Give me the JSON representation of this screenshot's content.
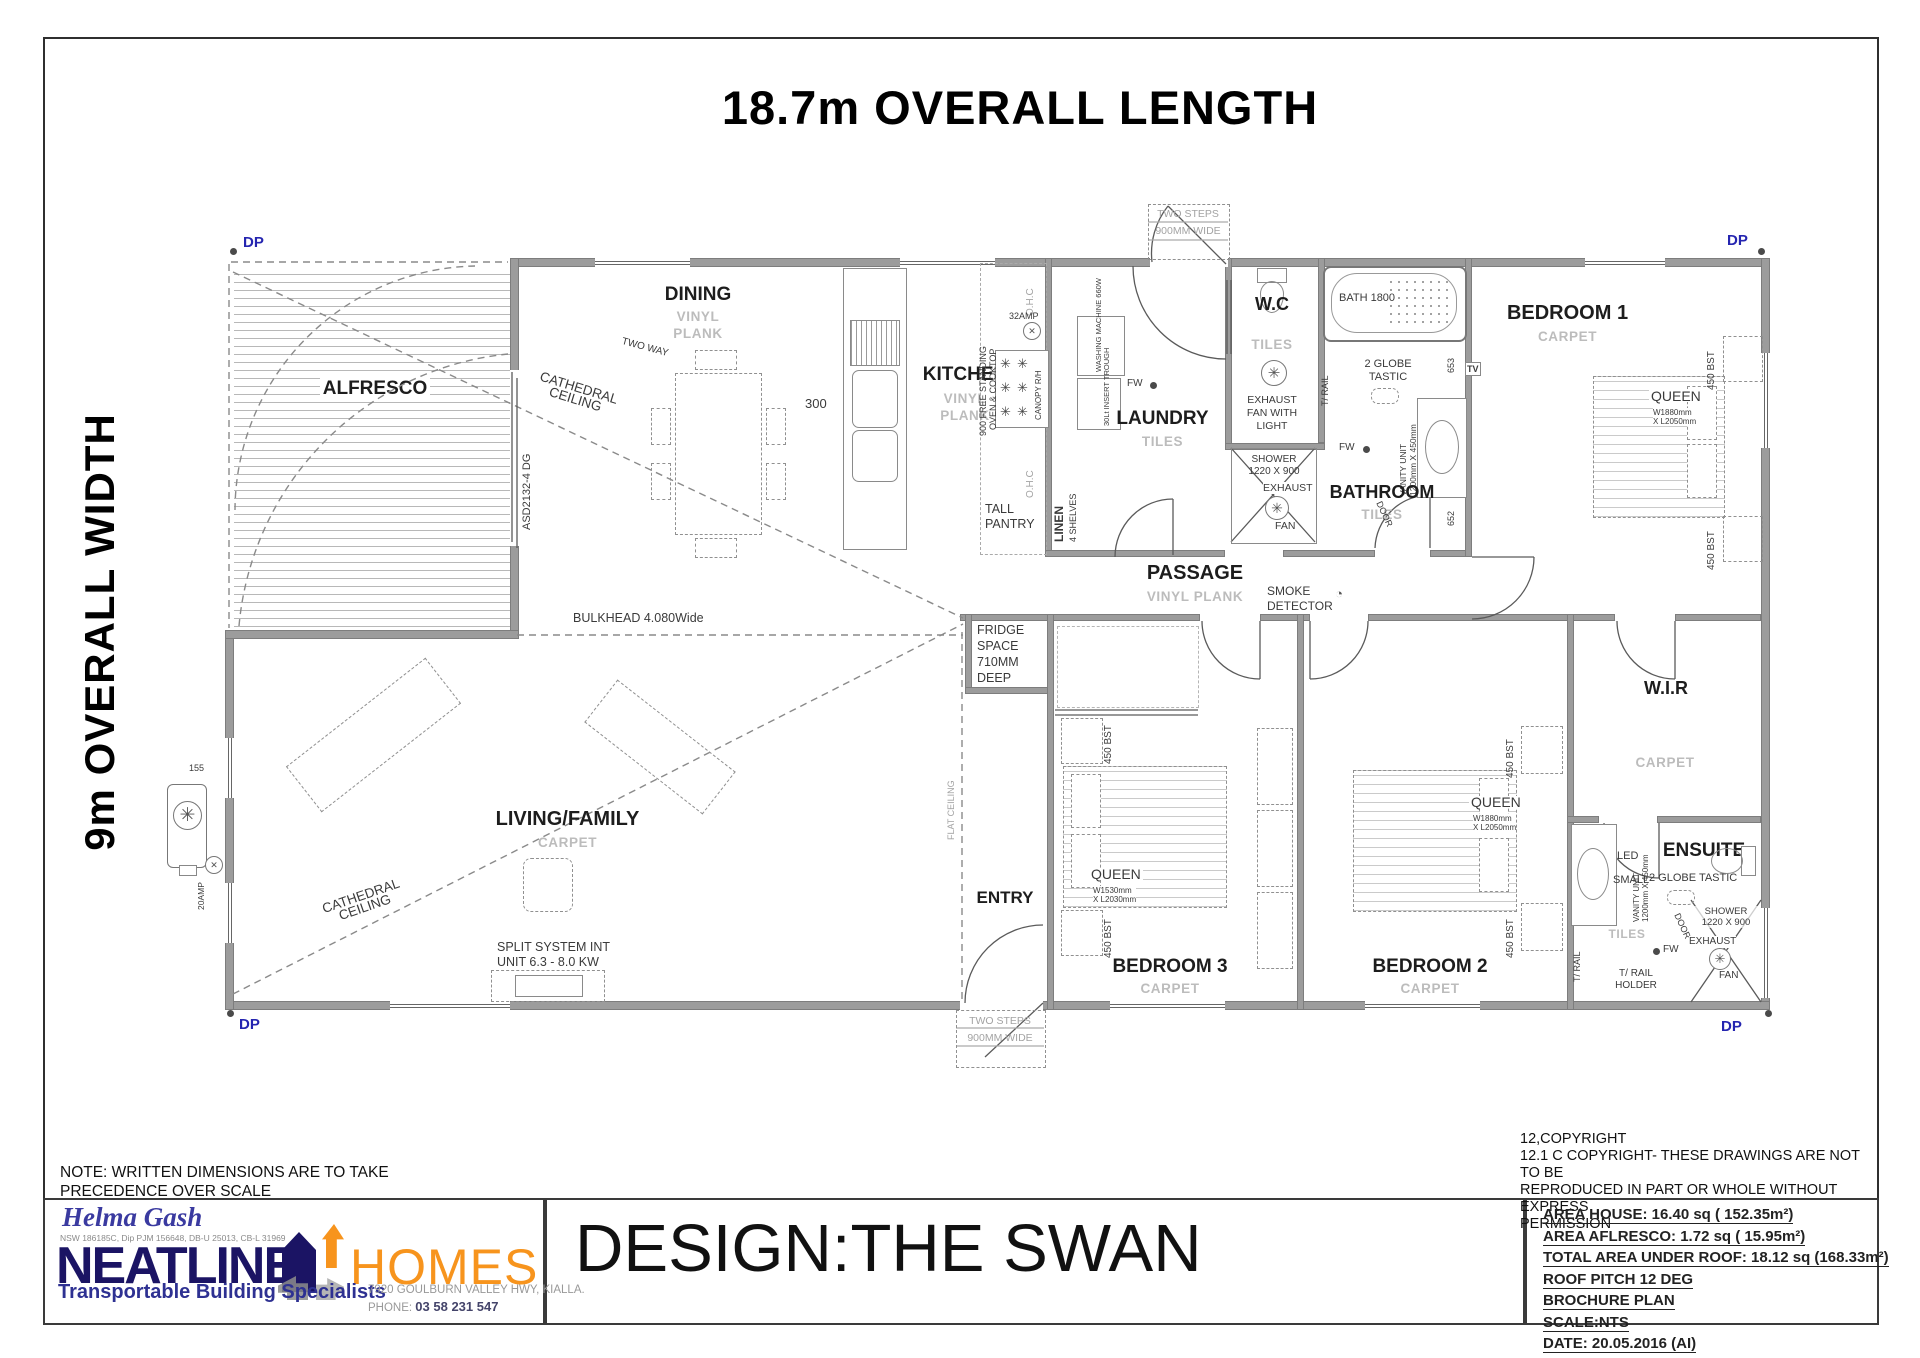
{
  "sheet": {
    "overall_length": "18.7m OVERALL LENGTH",
    "overall_width": "9m OVERALL WIDTH",
    "note1": "NOTE: WRITTEN DIMENSIONS ARE TO TAKE",
    "note2": "PRECEDENCE OVER SCALE"
  },
  "rooms": {
    "alfresco": "ALFRESCO",
    "dining": "DINING",
    "kitchen": "KITCHEN",
    "laundry": "LAUNDRY",
    "wc": "W.C",
    "bathroom": "BATHROOM",
    "bedroom1": "BEDROOM 1",
    "passage": "PASSAGE",
    "living": "LIVING/FAMILY",
    "entry": "ENTRY",
    "bedroom3": "BEDROOM 3",
    "bedroom2": "BEDROOM 2",
    "wir": "W.I.R",
    "ensuite": "ENSUITE"
  },
  "ann": {
    "dp": "DP",
    "vinyl": "VINYL",
    "plank": "PLANK",
    "tiles": "TILES",
    "carpet": "CARPET",
    "cathedral1": "CATHEDRAL",
    "cathedral2": "CEILING",
    "two_way": "TWO WAY",
    "asd": "ASD2132-4 DG",
    "bulkhead": "BULKHEAD 4.080Wide",
    "flat_ceiling": "FLAT CEILING",
    "steps1": "TWO STEPS",
    "steps2": "900MM WIDE",
    "ohc": "O.H.C",
    "amp32": "32AMP",
    "amp20": "20AMP",
    "d155": "155",
    "d300": "300",
    "d653": "653",
    "d652": "652",
    "oven1": "900 FREE STANDING",
    "oven2": "OVEN & COOKTOP",
    "canopy": "CANOPY R/H",
    "wm": "WASHING MACHINE 660W",
    "trough": "30Lt INSERT TROUGH",
    "fw": "FW",
    "pantry1": "TALL",
    "pantry2": "PANTRY",
    "linen": "LINEN",
    "shelves": "4 SHELVES",
    "bath": "BATH 1800",
    "globe1": "2 GLOBE",
    "globe2": "TASTIC",
    "tv": "TV",
    "trail": "T/ RAIL",
    "trailh1": "T/ RAIL",
    "trailh2": "HOLDER",
    "vanity1": "VANITY UNIT",
    "vanity2": "1200mm X 450mm",
    "exh1": "EXHAUST",
    "exh2": "FAN WITH",
    "exh3": "LIGHT",
    "fanword": "FAN",
    "shower1": "SHOWER",
    "shower2": "1220 X 900",
    "door": "DOOR",
    "smoke1": "SMOKE",
    "smoke2": "DETECTOR",
    "fridge1": "FRIDGE",
    "fridge2": "SPACE",
    "fridge3": "710MM",
    "fridge4": "DEEP",
    "queen": "QUEEN",
    "qd1": "W1880mm",
    "qd2": "X L2050mm",
    "qd3a": "W1530mm",
    "qd3b": "X L2030mm",
    "bst": "450 BST",
    "split1": "SPLIT SYSTEM INT",
    "split2": "UNIT 6.3 - 8.0 KW",
    "led": "LED",
    "small": "SMALL"
  },
  "icons": {
    "fan_glyph": "✳",
    "cross_glyph": "✕",
    "smoke_glyph": "◔",
    "burner_glyph": "✳"
  },
  "tb": {
    "helma": "Helma Gash",
    "creds": "NSW 186185C, Dip PJM 156648, DB-U 25013, CB-L 31969",
    "brand1": "NEATLINE",
    "brand2": "HOMES",
    "tagline": "Transportable Building Specialists",
    "address": "7920 GOULBURN VALLEY HWY, KIALLA.",
    "phone_label": "PHONE:",
    "phone": "03 58 231 547",
    "design": "DESIGN:THE SWAN",
    "copyright": [
      "12,COPYRIGHT",
      "12.1 C COPYRIGHT- THESE DRAWINGS ARE NOT TO BE",
      "REPRODUCED IN PART OR WHOLE WITHOUT EXPRESS",
      "PERMISSION"
    ],
    "specs": [
      "AREA HOUSE: 16.40 sq ( 152.35m²)",
      "AREA AFLRESCO: 1.72 sq ( 15.95m²)",
      "TOTAL AREA UNDER ROOF: 18.12 sq  (168.33m²)",
      "ROOF PITCH 12 DEG",
      "BROCHURE PLAN",
      "SCALE:NTS",
      "DATE: 20.05.2016 (AI)"
    ]
  },
  "colors": {
    "wall": "#9c9c9c",
    "navy": "#1b1464",
    "orange": "#f7941d",
    "blue": "#2e3192",
    "dp_blue": "#2525b0"
  }
}
